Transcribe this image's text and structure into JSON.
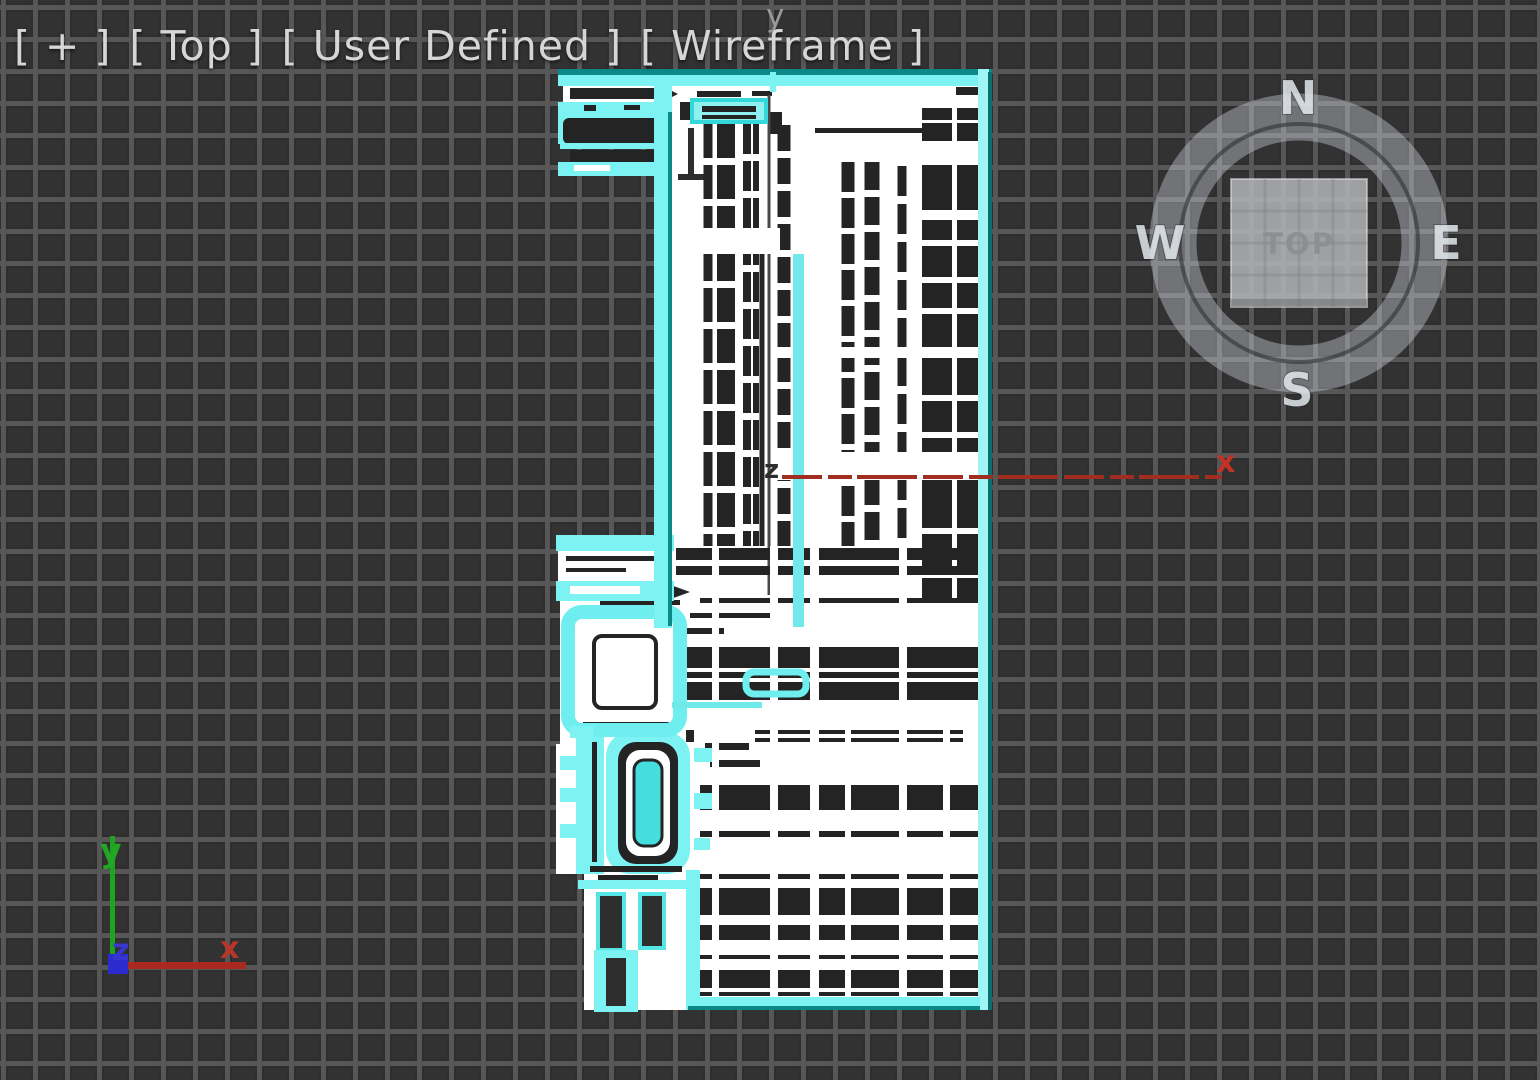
{
  "viewport_label": {
    "segments": [
      "[ + ]",
      "[ Top ]",
      "[ User Defined ]",
      "[ Wireframe ]"
    ]
  },
  "compass": {
    "north": "N",
    "east": "E",
    "south": "S",
    "west": "W",
    "cube_face_label": "TOP"
  },
  "world_axis_tripod": {
    "x_label": "x",
    "y_label": "y",
    "z_label": "z"
  },
  "transform_gizmo": {
    "x_label": "x",
    "y_label": "y",
    "z_label": "z"
  },
  "colors": {
    "viewport_background": "#2e2e2e",
    "grid_line": "#575757",
    "selection_highlight": "#7df2f2",
    "selection_shadow": "#0d8888",
    "wireframe_white": "#ffffff",
    "wireframe_dark": "#242424",
    "axis_x_red": "#a82a1f",
    "axis_y_green": "#22a022",
    "axis_z_blue": "#2b2bd0",
    "label_text": "#d6d6d6"
  }
}
